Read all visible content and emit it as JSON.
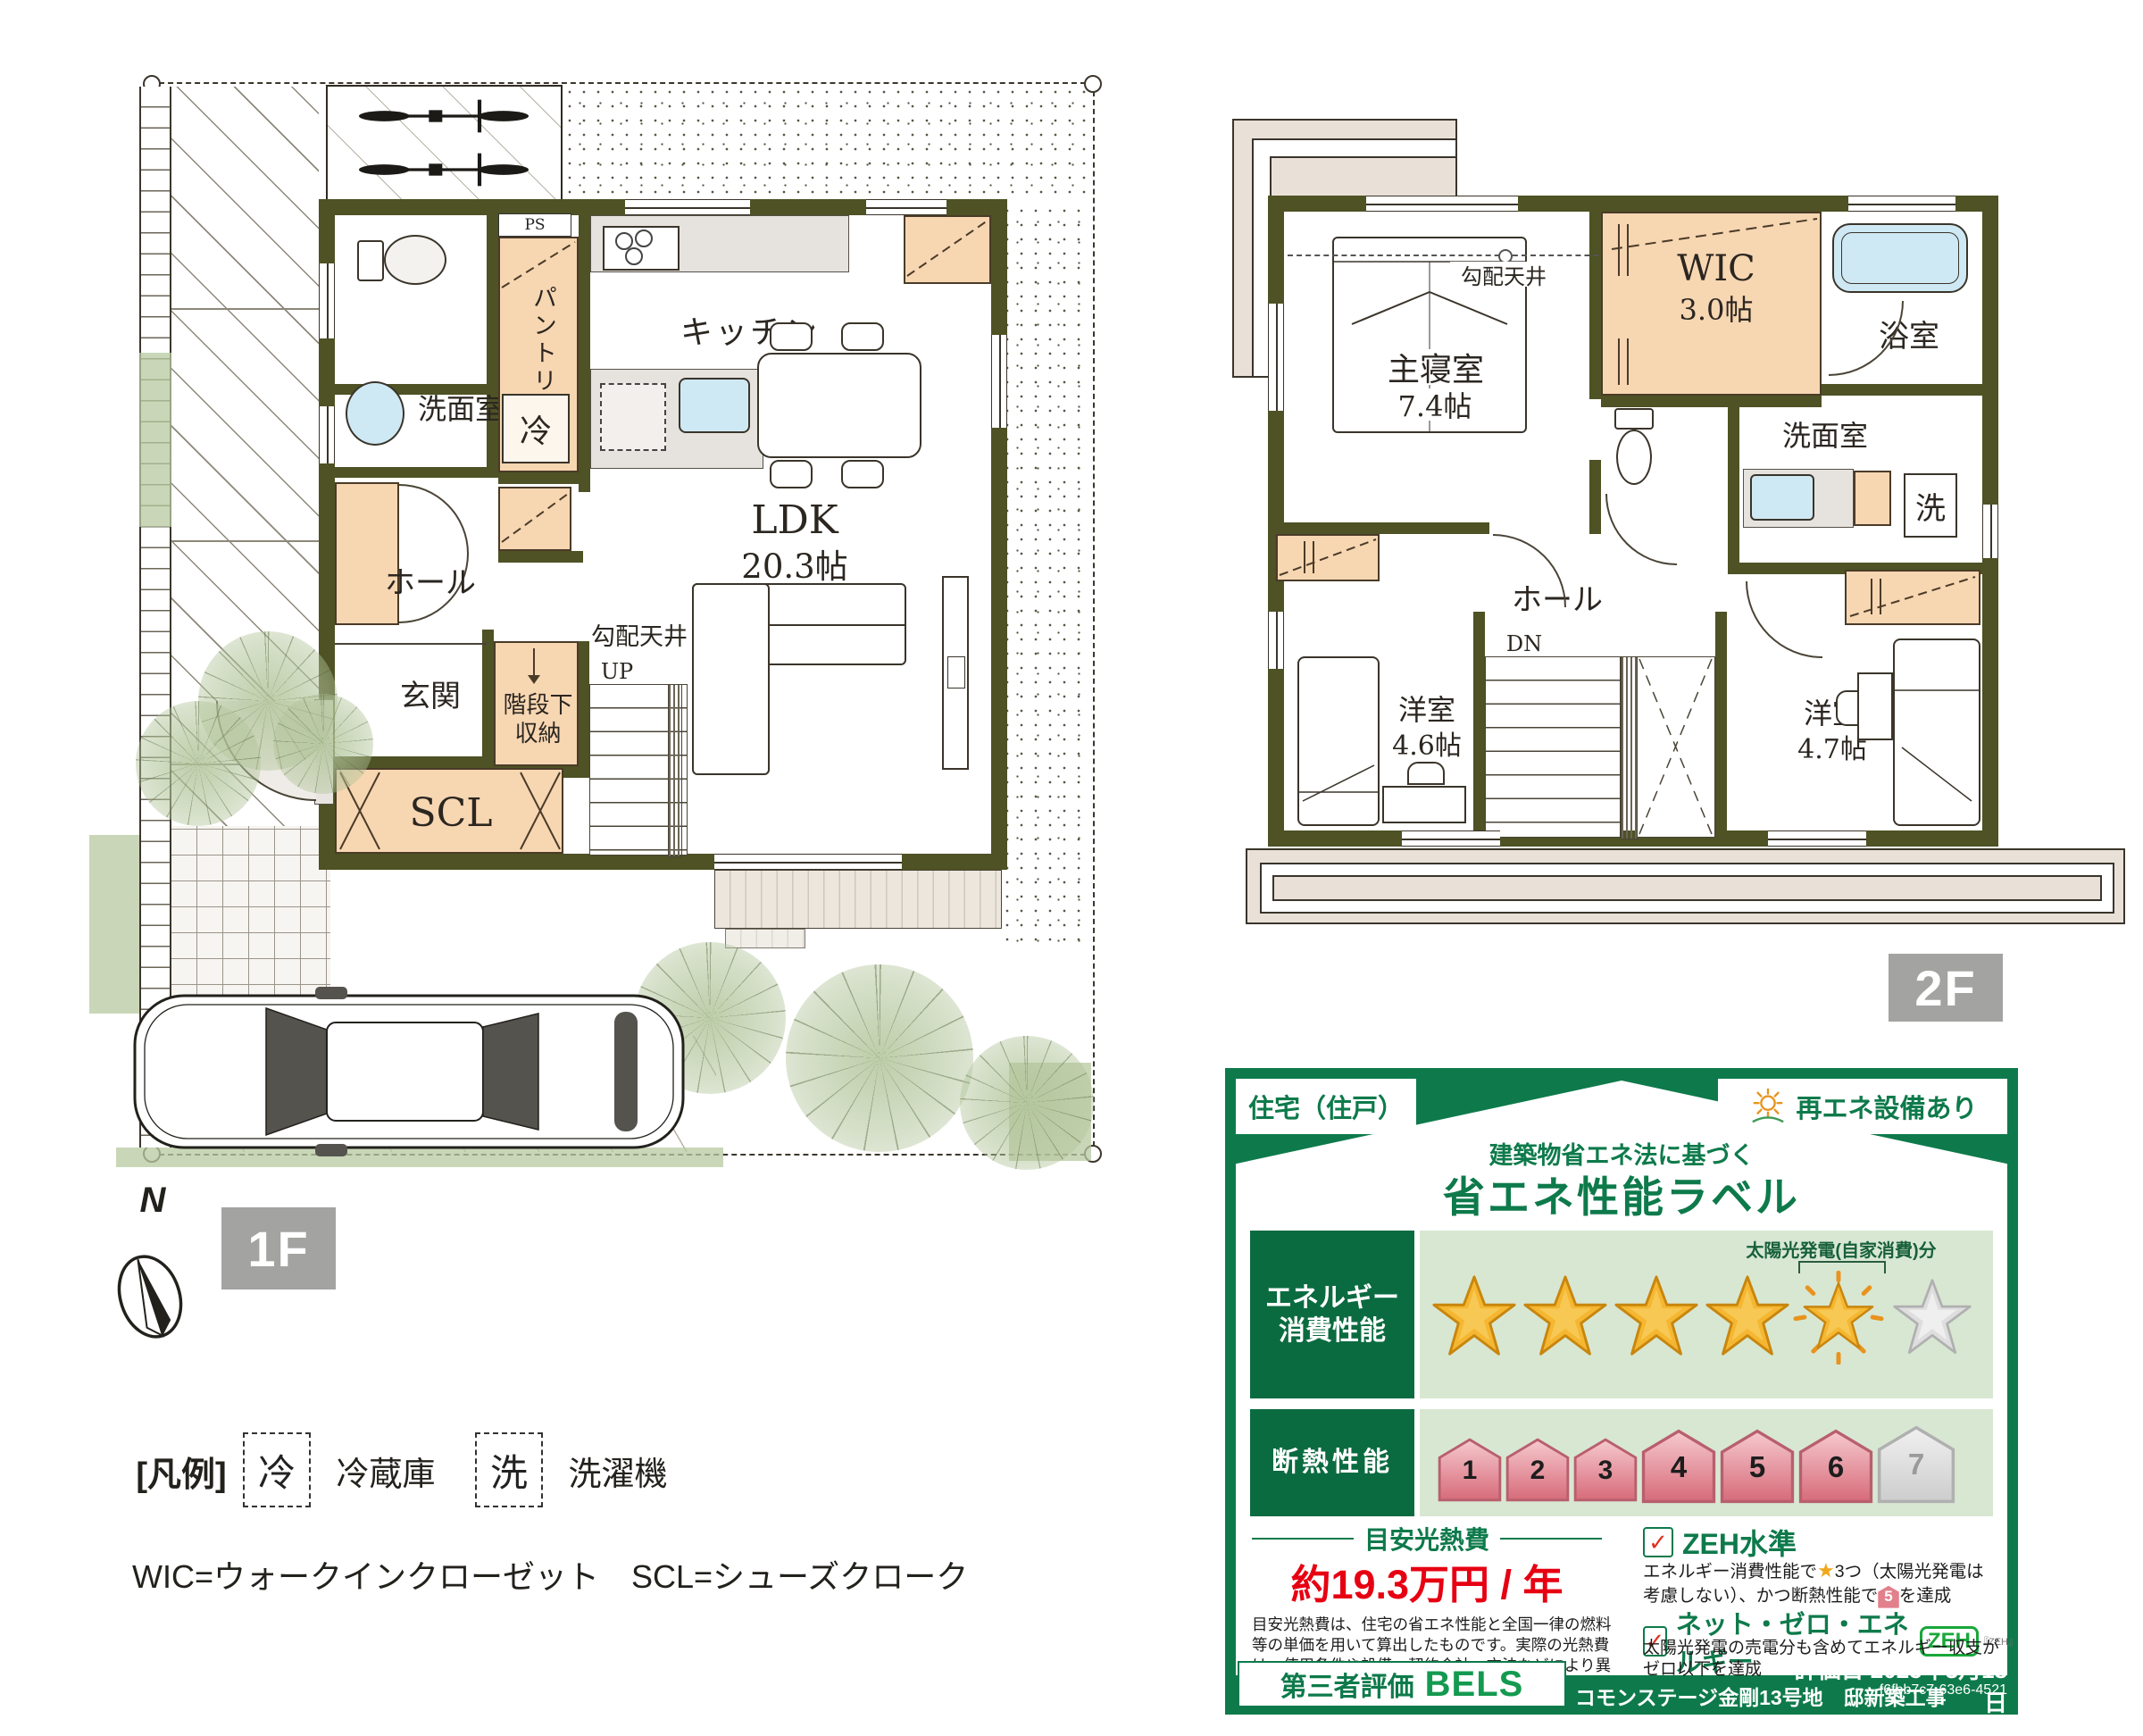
{
  "plan_1f": {
    "badge": "1F",
    "rooms": {
      "washroom": "洗面室",
      "pantry": "パントリー",
      "fridge": "冷",
      "ps": "PS",
      "kitchen": "キッチン",
      "ldk_name": "LDK",
      "ldk_size": "20.3帖",
      "hall": "ホール",
      "entrance": "玄関",
      "scl": "SCL",
      "under_stairs_line1": "階段下",
      "under_stairs_line2": "収納",
      "sloped_ceiling": "勾配天井",
      "up": "UP"
    }
  },
  "plan_2f": {
    "badge": "2F",
    "rooms": {
      "master": "主寝室",
      "master_size": "7.4帖",
      "sloped_ceiling": "勾配天井",
      "wic": "WIC",
      "wic_size": "3.0帖",
      "bath": "浴室",
      "washroom": "洗面室",
      "washer": "洗",
      "hall": "ホール",
      "dn": "DN",
      "west1": "洋室",
      "west1_size": "4.6帖",
      "west2": "洋室",
      "west2_size": "4.7帖"
    }
  },
  "compass": {
    "north": "N"
  },
  "legend": {
    "title": "[凡例]",
    "fridge_mark": "冷",
    "fridge_label": "冷蔵庫",
    "washer_mark": "洗",
    "washer_label": "洗濯機",
    "abbr": "WIC=ウォークインクローゼット　SCL=シューズクローク"
  },
  "energy_label": {
    "usage_type": "住宅（住戸）",
    "renewable": "再エネ設備あり",
    "subtitle": "建築物省エネ法に基づく",
    "title": "省エネ性能ラベル",
    "energy_row_label_1": "エネルギー",
    "energy_row_label_2": "消費性能",
    "solar_note": "太陽光発電(自家消費)分",
    "stars_gold": 4,
    "stars_solar": 1,
    "stars_empty": 1,
    "insulation_label": "断熱性能",
    "insulation_levels": [
      "1",
      "2",
      "3",
      "4",
      "5",
      "6",
      "7"
    ],
    "insulation_achieved": 6,
    "cost_title": "目安光熱費",
    "cost_value": "約19.3万円 / 年",
    "cost_note": "目安光熱費は、住宅の省エネ性能と全国一律の燃料等の単価を用いて算出したものです。実際の光熱費は、使用条件や設備、契約会社・方法などにより異なります。",
    "zeh_level": "ZEH水準",
    "zeh_desc_1": "エネルギー消費性能で",
    "zeh_star": "★",
    "zeh_desc_2": "3つ（太陽光発電",
    "zeh_desc_3": "は考慮しない）、かつ断熱性能で",
    "zeh_badge": "5",
    "zeh_desc_4": "を達成",
    "nze": "ネット・ゼロ・エネルギー",
    "zeh_logo": "ZEH",
    "zeh_logo_sub": "『ZEH』",
    "nze_desc": "太陽光発電の売電分も含めてエネルギー収支がゼロ以下を達成",
    "evaluator": "第三者評価",
    "bels": "BELS",
    "project": "コモンステージ金剛13号地　邸新築工事",
    "eval_date": "評価日 2025年3月18日",
    "eval_id": "f6fbb7c7-63e6-4521",
    "colors": {
      "green": "#0e7a4b",
      "red": "#e60012",
      "gold": "#f5b731",
      "pink": "#d76b7a",
      "wall_olive": "#4e5224",
      "closet_orange": "#f7d6b2"
    }
  }
}
